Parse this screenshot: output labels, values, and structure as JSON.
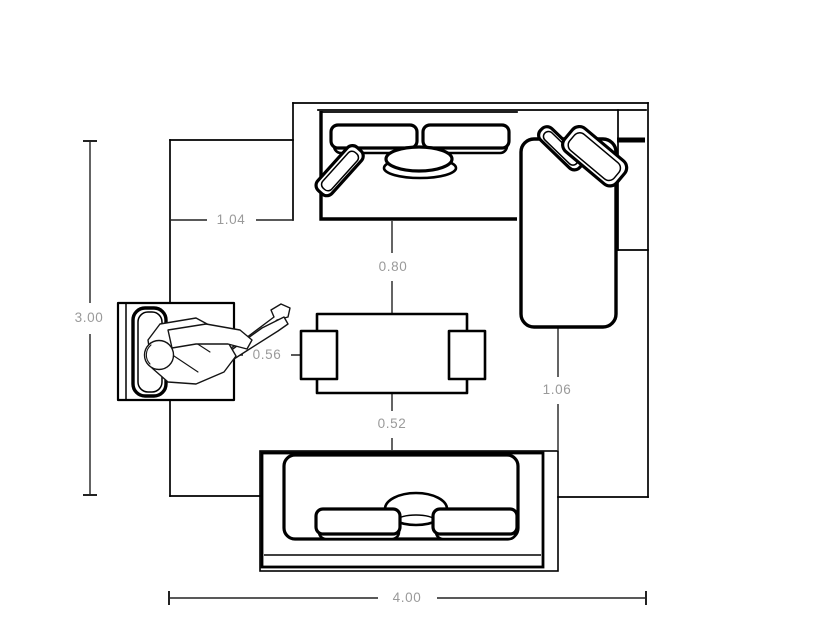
{
  "plan": {
    "title": "living-room furniture layout plan",
    "units": "meters",
    "colors": {
      "line": "#000000",
      "dimension_text": "#9a9a9a",
      "background": "#ffffff"
    },
    "dimensions": {
      "room_depth": "3.00",
      "room_width": "4.00",
      "wall_to_sectional": "1.04",
      "sectional_to_table": "0.80",
      "armchair_to_table": "0.56",
      "table_to_sofa": "0.52",
      "chaise_to_sofa": "1.06"
    },
    "furniture": {
      "sectional": "sectional-sofa-with-chaise",
      "sofa": "two-seat-sofa",
      "armchair": "armchair-with-seated-person",
      "table": "coffee-table-with-side-stools"
    }
  }
}
